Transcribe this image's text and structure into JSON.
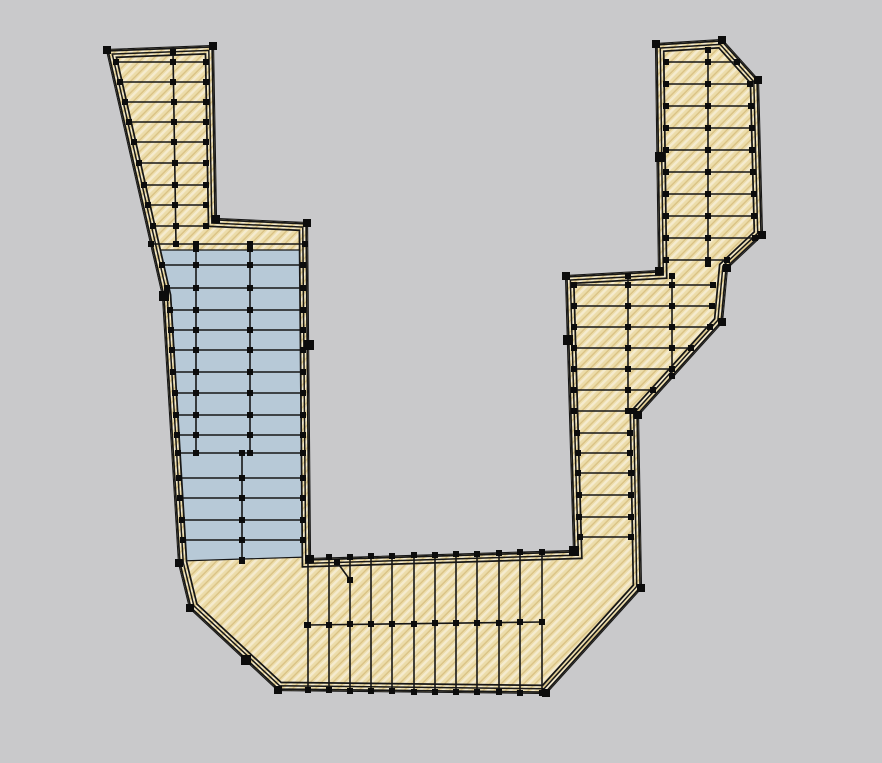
{
  "app": {
    "title": "deck-framing-plan-view",
    "view_note": ""
  },
  "colors": {
    "background": "#c9c9cb",
    "line": "#171717",
    "node": "#0c0c0c",
    "wood_base": "#ecdcaa",
    "wood_hatch_light": "#f5ebcf",
    "wood_hatch_dark": "#d9c183",
    "panel_blue": "#b7c9d7"
  },
  "geometry": {
    "outline": [
      [
        107,
        50
      ],
      [
        213,
        46
      ],
      [
        216,
        219
      ],
      [
        307,
        223
      ],
      [
        310,
        559
      ],
      [
        574,
        551
      ],
      [
        566,
        276
      ],
      [
        659,
        271
      ],
      [
        656,
        44
      ],
      [
        722,
        40
      ],
      [
        758,
        80
      ],
      [
        762,
        235
      ],
      [
        727,
        268
      ],
      [
        722,
        322
      ],
      [
        638,
        415
      ],
      [
        641,
        588
      ],
      [
        546,
        693
      ],
      [
        278,
        690
      ],
      [
        190,
        608
      ],
      [
        179,
        563
      ],
      [
        163,
        296
      ]
    ],
    "blue_panel": [
      [
        152,
        250
      ],
      [
        305,
        250
      ],
      [
        308,
        557
      ],
      [
        180,
        561
      ],
      [
        164,
        297
      ]
    ],
    "rim_rings": [
      {
        "width": 17,
        "paint": "line"
      },
      {
        "width": 13.5,
        "paint": "hatch"
      },
      {
        "width": 10,
        "paint": "line"
      },
      {
        "width": 7,
        "paint": "hatch"
      },
      {
        "width": 3.5,
        "paint": "line"
      }
    ],
    "line_groups": {
      "left-arm-joists": [
        [
          116,
          62,
          206,
          62
        ],
        [
          120,
          82,
          206,
          82
        ],
        [
          125,
          102,
          206,
          102
        ],
        [
          129,
          122,
          206,
          122
        ],
        [
          134,
          142,
          206,
          142
        ],
        [
          139,
          163,
          206,
          163
        ],
        [
          144,
          185,
          206,
          185
        ],
        [
          148,
          205,
          206,
          205
        ],
        [
          153,
          226,
          206,
          226
        ],
        [
          151,
          244,
          305,
          244
        ]
      ],
      "left-arm-nailer": [
        [
          173,
          52,
          176,
          244
        ]
      ],
      "infill-panel-joists": [
        [
          162,
          265,
          303,
          265
        ],
        [
          167,
          288,
          303,
          288
        ],
        [
          170,
          310,
          303,
          310
        ],
        [
          171,
          330,
          303,
          330
        ],
        [
          172,
          350,
          303,
          350
        ],
        [
          173,
          372,
          303,
          372
        ],
        [
          175,
          393,
          303,
          393
        ],
        [
          176,
          415,
          303,
          415
        ],
        [
          177,
          435,
          303,
          435
        ],
        [
          178,
          453,
          303,
          453
        ],
        [
          179,
          478,
          303,
          478
        ],
        [
          180,
          498,
          303,
          498
        ],
        [
          182,
          520,
          303,
          520
        ],
        [
          183,
          540,
          303,
          540
        ]
      ],
      "infill-panel-nailers": [
        [
          196,
          249,
          196,
          453
        ],
        [
          250,
          249,
          250,
          453
        ],
        [
          242,
          453,
          242,
          561
        ]
      ],
      "bottom-deck-joists": [
        [
          308,
          558,
          308,
          690
        ],
        [
          329,
          557,
          329,
          690
        ],
        [
          350,
          557,
          350,
          691
        ],
        [
          371,
          556,
          371,
          691
        ],
        [
          392,
          556,
          392,
          691
        ],
        [
          414,
          555,
          414,
          692
        ],
        [
          435,
          555,
          435,
          692
        ],
        [
          456,
          554,
          456,
          692
        ],
        [
          477,
          554,
          477,
          692
        ],
        [
          499,
          553,
          499,
          692
        ],
        [
          520,
          552,
          520,
          693
        ],
        [
          542,
          552,
          542,
          693
        ]
      ],
      "bottom-deck-blocking": [
        [
          307,
          625,
          542,
          622
        ]
      ],
      "misc-brace": [
        [
          337,
          562,
          350,
          580
        ]
      ],
      "right-arm-upper-joists": [
        [
          666,
          62,
          737,
          62
        ],
        [
          666,
          84,
          750,
          84
        ],
        [
          666,
          106,
          751,
          106
        ],
        [
          666,
          128,
          752,
          128
        ],
        [
          666,
          150,
          752,
          150
        ],
        [
          666,
          172,
          753,
          172
        ],
        [
          666,
          194,
          754,
          194
        ],
        [
          666,
          216,
          754,
          216
        ],
        [
          666,
          238,
          755,
          238
        ],
        [
          666,
          260,
          727,
          260
        ]
      ],
      "right-arm-upper-nailer": [
        [
          708,
          50,
          708,
          264
        ]
      ],
      "right-arm-mid-joists": [
        [
          574,
          285,
          713,
          285
        ],
        [
          574,
          306,
          712,
          306
        ],
        [
          574,
          327,
          710,
          327
        ],
        [
          574,
          348,
          691,
          348
        ],
        [
          574,
          369,
          672,
          369
        ],
        [
          574,
          390,
          653,
          390
        ],
        [
          574,
          411,
          634,
          411
        ]
      ],
      "right-arm-mid-nailers": [
        [
          628,
          276,
          628,
          411
        ],
        [
          672,
          276,
          672,
          376
        ]
      ],
      "right-arm-lower-joists": [
        [
          577,
          433,
          630,
          433
        ],
        [
          578,
          453,
          630,
          453
        ],
        [
          578,
          473,
          631,
          473
        ],
        [
          579,
          495,
          631,
          495
        ],
        [
          579,
          517,
          631,
          517
        ],
        [
          580,
          537,
          631,
          537
        ]
      ]
    },
    "extra_nodes": [
      [
        173,
        62
      ],
      [
        173,
        82
      ],
      [
        174,
        102
      ],
      [
        174,
        122
      ],
      [
        174,
        142
      ],
      [
        175,
        163
      ],
      [
        175,
        185
      ],
      [
        175,
        205
      ],
      [
        176,
        226
      ],
      [
        196,
        244
      ],
      [
        250,
        244
      ],
      [
        196,
        265
      ],
      [
        196,
        288
      ],
      [
        196,
        310
      ],
      [
        196,
        330
      ],
      [
        196,
        350
      ],
      [
        196,
        372
      ],
      [
        196,
        393
      ],
      [
        196,
        415
      ],
      [
        196,
        435
      ],
      [
        250,
        265
      ],
      [
        250,
        288
      ],
      [
        250,
        310
      ],
      [
        250,
        330
      ],
      [
        250,
        350
      ],
      [
        250,
        372
      ],
      [
        250,
        393
      ],
      [
        250,
        415
      ],
      [
        250,
        435
      ],
      [
        242,
        478
      ],
      [
        242,
        498
      ],
      [
        242,
        520
      ],
      [
        242,
        540
      ],
      [
        242,
        560
      ],
      [
        308,
        625
      ],
      [
        329,
        625
      ],
      [
        350,
        624
      ],
      [
        371,
        624
      ],
      [
        392,
        624
      ],
      [
        414,
        624
      ],
      [
        435,
        623
      ],
      [
        456,
        623
      ],
      [
        477,
        623
      ],
      [
        499,
        623
      ],
      [
        520,
        622
      ],
      [
        542,
        622
      ],
      [
        708,
        62
      ],
      [
        708,
        84
      ],
      [
        708,
        106
      ],
      [
        708,
        128
      ],
      [
        708,
        150
      ],
      [
        708,
        172
      ],
      [
        708,
        194
      ],
      [
        708,
        216
      ],
      [
        708,
        238
      ],
      [
        708,
        260
      ],
      [
        628,
        285
      ],
      [
        628,
        306
      ],
      [
        628,
        327
      ],
      [
        628,
        348
      ],
      [
        628,
        369
      ],
      [
        628,
        390
      ],
      [
        672,
        285
      ],
      [
        672,
        306
      ],
      [
        672,
        327
      ],
      [
        672,
        348
      ],
      [
        672,
        369
      ]
    ],
    "corner_nodes": [
      [
        107,
        50
      ],
      [
        213,
        46
      ],
      [
        216,
        219
      ],
      [
        307,
        223
      ],
      [
        310,
        559
      ],
      [
        574,
        551
      ],
      [
        566,
        276
      ],
      [
        659,
        271
      ],
      [
        656,
        44
      ],
      [
        722,
        40
      ],
      [
        758,
        80
      ],
      [
        762,
        235
      ],
      [
        727,
        268
      ],
      [
        722,
        322
      ],
      [
        638,
        415
      ],
      [
        641,
        588
      ],
      [
        546,
        693
      ],
      [
        278,
        690
      ],
      [
        190,
        608
      ],
      [
        179,
        563
      ],
      [
        163,
        296
      ]
    ],
    "edge_ticks": [
      [
        164,
        296
      ],
      [
        309,
        345
      ],
      [
        660,
        157
      ],
      [
        568,
        340
      ],
      [
        246,
        660
      ],
      [
        574,
        551
      ]
    ]
  }
}
